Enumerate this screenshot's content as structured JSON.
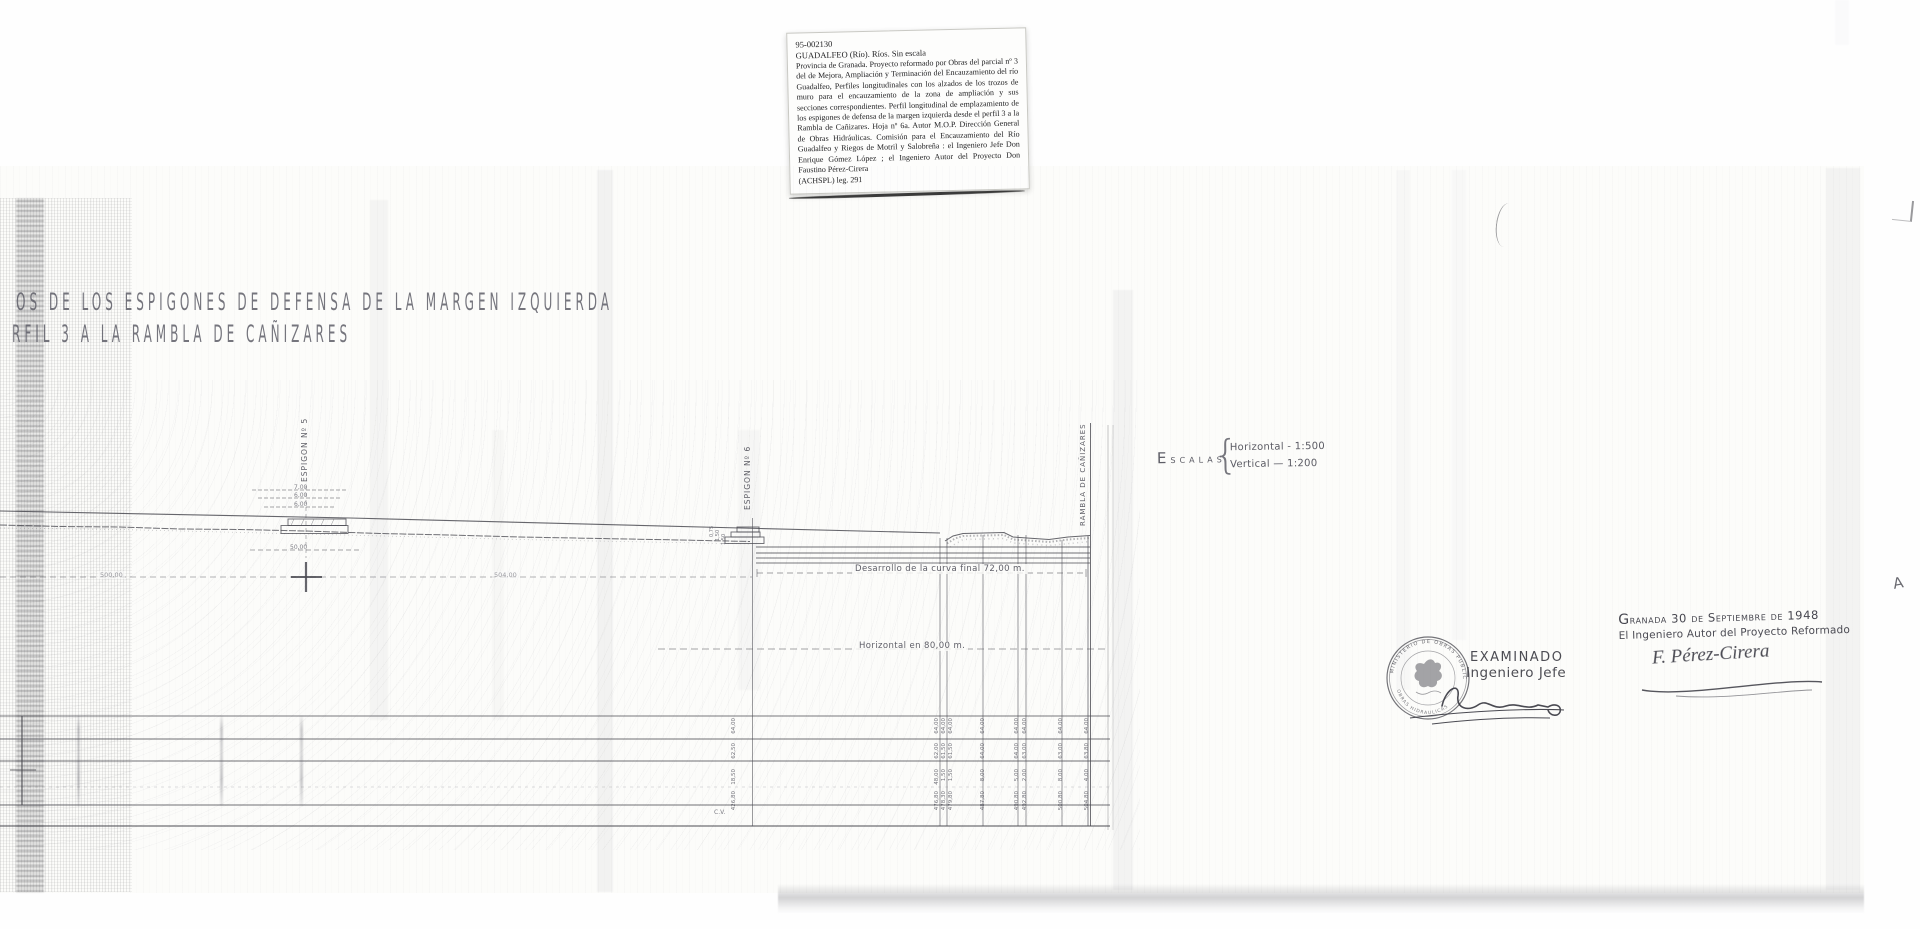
{
  "archive_label": {
    "id": "95-002130",
    "heading": "GUADALFEO (Río). Ríos. Sin escala",
    "body": "Provincia de Granada. Proyecto reformado por Obras del parcial nº 3 del de Mejora, Ampliación y Terminación del Encauzamiento del río Guadalfeo, Perfiles longitudinales con los alzados de los trozos de muro para el encauzamiento de la zona de ampliación y sus secciones correspondientes. Perfil longitudinal de emplazamiento de los espigones de defensa de la margen izquierda desde el perfil 3 a la Rambla de Cañizares. Hoja nº 6a. Autor M.O.P. Dirección General de Obras Hidráulicas. Comisión para el Encauzamiento del Río Guadalfeo y Riegos de Motril y Salobreña : el Ingeniero Jefe Don Enrique Gómez López ; el Ingeniero Autor del Proyecto Don Faustino Pérez-Cirera",
    "footer": "(ACHSPL) leg. 291"
  },
  "titles": {
    "line1": "OS DE LOS ESPIGONES DE DEFENSA DE LA MARGEN IZQUIERDA",
    "line2": "RFIL 3 A LA RAMBLA DE CAÑIZARES"
  },
  "drawing": {
    "ink_color": "#4b4b52",
    "section_labels": {
      "espigon5": "Espigon Nº 5",
      "espigon6": "Espigon Nº 6",
      "rambla": "Rambla de Cañizares"
    },
    "scales": {
      "label": "Escalas",
      "brace": "{",
      "horizontal": "Horizontal - 1:500",
      "vertical": "Vertical — 1:200"
    },
    "annotations": {
      "curve_length": "Desarrollo de la curva final 72,00 m.",
      "horizontal_length": "Horizontal en 80,00 m.",
      "datum_left": "500,00",
      "datum_mid": "504,00",
      "corner_note": "C.V.",
      "espigon5_dims": [
        "7,00",
        "6,00",
        "6,00",
        "50,00"
      ],
      "espigon6_dims": [
        "0,75",
        "1,50",
        "1,50"
      ]
    },
    "table_columns": [
      {
        "x": 735,
        "values": [
          "64,00",
          "62,50",
          "18,50",
          "426,80"
        ]
      },
      {
        "x": 938,
        "values": [
          "64,00",
          "62,00",
          "48,00",
          "476,80"
        ]
      },
      {
        "x": 945,
        "values": [
          "64,00",
          "61,50",
          "1,50",
          "478,30"
        ]
      },
      {
        "x": 952,
        "values": [
          "64,00",
          "61,50",
          "1,50",
          "479,80"
        ]
      },
      {
        "x": 984,
        "values": [
          "64,00",
          "64,00",
          "8,00",
          "487,80"
        ]
      },
      {
        "x": 1018,
        "values": [
          "64,00",
          "64,00",
          "5,00",
          "490,80"
        ]
      },
      {
        "x": 1026,
        "values": [
          "64,00",
          "63,00",
          "2,00",
          "492,80"
        ]
      },
      {
        "x": 1062,
        "values": [
          "64,00",
          "63,00",
          "8,00",
          "500,80"
        ]
      },
      {
        "x": 1088,
        "values": [
          "64,00",
          "63,80",
          "4,00",
          "504,80"
        ]
      }
    ]
  },
  "approval": {
    "stamp": {
      "line1": "EXAMINADO",
      "line2": "Ingeniero Jefe",
      "rim_top": "MINISTERIO DE OBRAS PUBLICAS",
      "rim_bottom": "OBRAS HIDRAULICAS"
    },
    "date_line": "Granada 30 de Septiembre de 1948",
    "role_line": "El Ingeniero Autor del Proyecto Reformado",
    "signature_name": "F. Pérez-Cirera",
    "side_mark": "A"
  }
}
